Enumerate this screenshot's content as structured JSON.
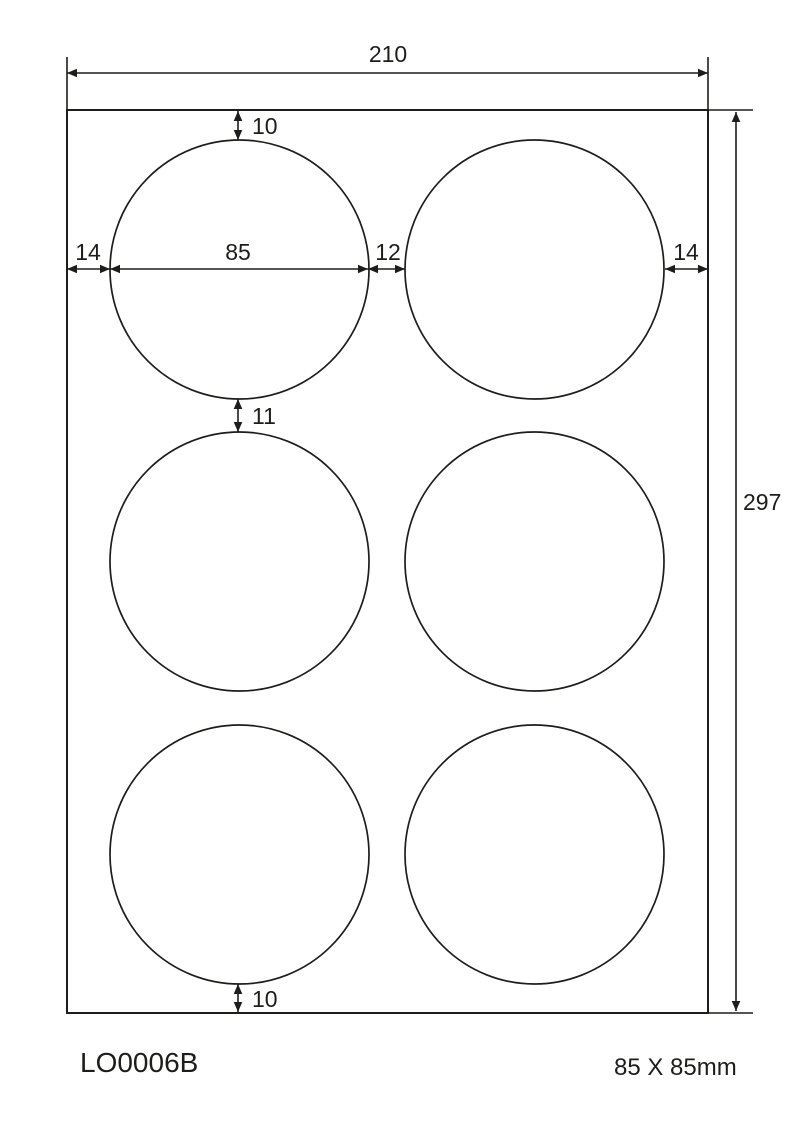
{
  "colors": {
    "ink": "#1d1d1b",
    "paper": "#ffffff"
  },
  "dimensions": {
    "sheet_width": "210",
    "sheet_height": "297",
    "top_margin": "10",
    "left_margin": "14",
    "label_diameter": "85",
    "column_gap": "12",
    "right_margin": "14",
    "row_gap": "11",
    "bottom_margin": "10"
  },
  "labels_grid": {
    "rows": 3,
    "columns": 2,
    "count": 6,
    "shape": "round"
  },
  "footer": {
    "product_code": "LO0006B",
    "label_size": "85 X 85mm"
  }
}
